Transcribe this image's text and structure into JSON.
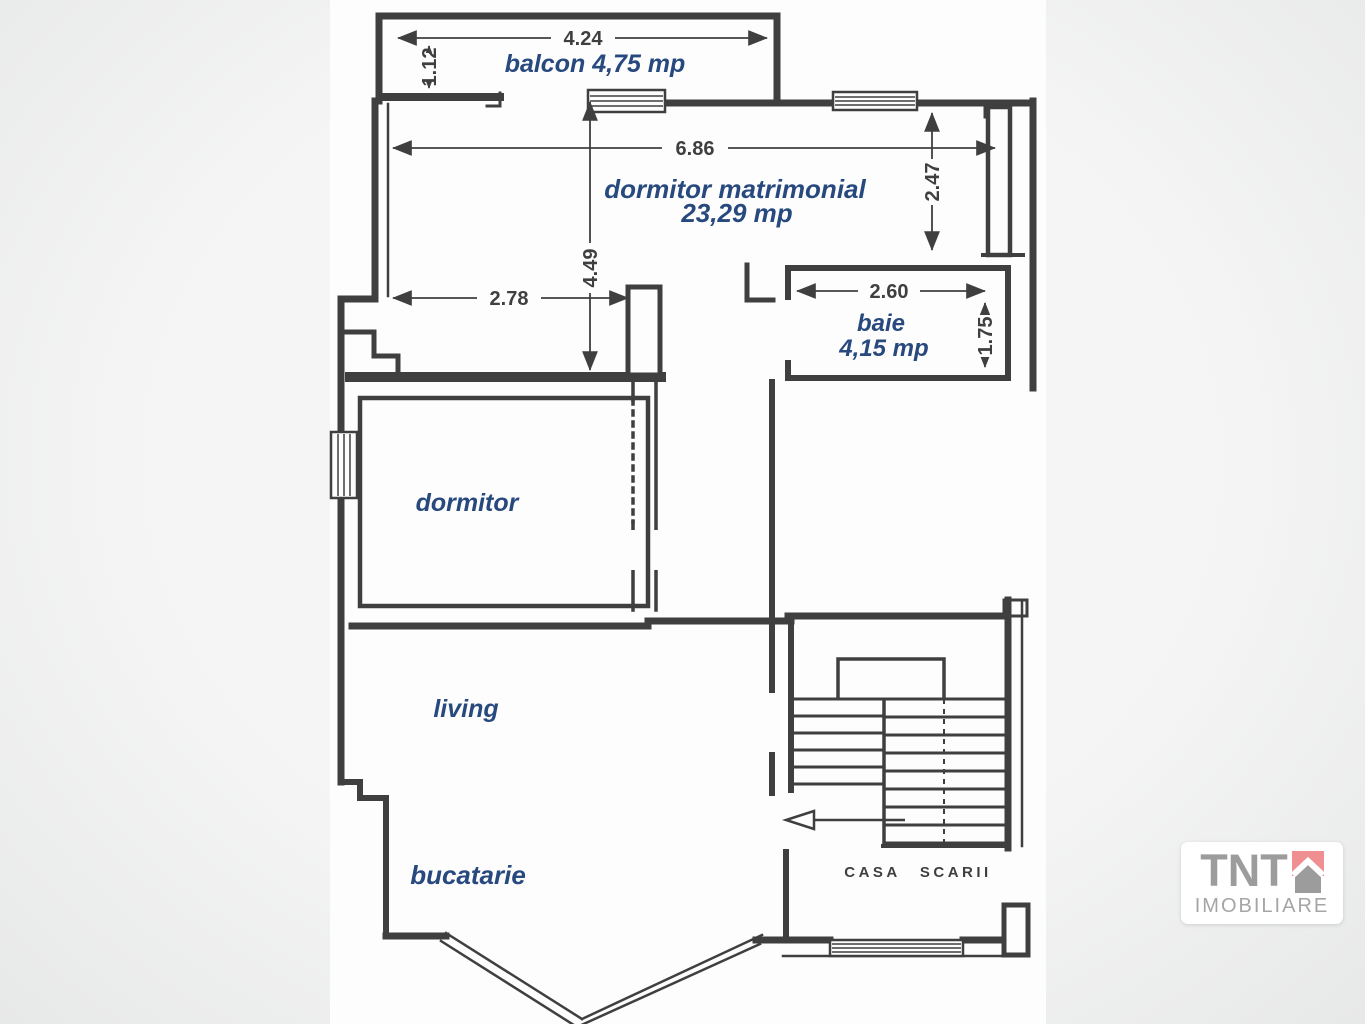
{
  "rooms": {
    "balcon": "balcon 4,75 mp",
    "dormitor_matrimonial_line1": "dormitor matrimonial",
    "dormitor_matrimonial_line2": "23,29 mp",
    "baie_line1": "baie",
    "baie_line2": "4,15 mp",
    "dormitor": "dormitor",
    "living": "living",
    "bucatarie": "bucatarie",
    "casa_scarii": "CASA SCARII"
  },
  "dimensions": {
    "balcony_width": "4.24",
    "balcony_depth": "1.12",
    "master_width": "6.86",
    "master_depth_right": "2.47",
    "master_depth_left": "4.49",
    "nook_width": "2.78",
    "bath_width": "2.60",
    "bath_depth": "1.75"
  },
  "logo": {
    "brand": "TNT",
    "subtitle": "IMOBILIARE"
  },
  "colors": {
    "ink": "#3f3f3f",
    "room_label_blue": "#27497e",
    "background": "#ececec",
    "paper": "#fdfdfe",
    "logo_gray": "#9c9c9c",
    "logo_red": "#ef8f92"
  }
}
